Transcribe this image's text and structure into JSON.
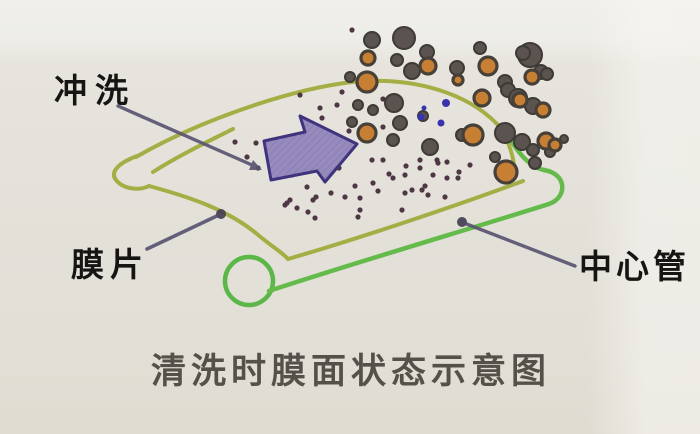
{
  "figure": {
    "labels": {
      "flush": "冲洗",
      "membrane": "膜片",
      "center_tube": "中心管"
    },
    "caption": "清洗时膜面状态示意图"
  },
  "colors": {
    "paper": "#e3e1d9",
    "membrane_line": "#a5ae44",
    "tube_line": "#64bb4b",
    "tube_circle": "#5ab748",
    "arrow_fill": "#978abc",
    "arrow_hatch": "#5e5090",
    "arrow_border": "#40337d",
    "pointer_line": "#5b5472",
    "pointer_dot": "#453f54",
    "dot": "#4e3744",
    "blue_dot": "#3934ae",
    "blob_dark": "#5a534f",
    "blob_edge": "#3e3a36",
    "blob_orange": "#c67f33",
    "blob_ring": "#474039",
    "label_color": "#171513",
    "caption_color": "#54514b"
  },
  "particles": {
    "dark_blobs": [
      [
        372,
        40,
        8
      ],
      [
        404,
        38,
        11
      ],
      [
        427,
        52,
        7
      ],
      [
        397,
        60,
        6
      ],
      [
        412,
        71,
        8
      ],
      [
        457,
        68,
        7
      ],
      [
        480,
        48,
        6
      ],
      [
        530,
        55,
        12
      ],
      [
        541,
        72,
        7
      ],
      [
        350,
        77,
        5
      ],
      [
        505,
        82,
        7
      ],
      [
        547,
        74,
        6
      ],
      [
        394,
        103,
        9
      ],
      [
        358,
        105,
        5
      ],
      [
        373,
        110,
        5
      ],
      [
        508,
        90,
        7
      ],
      [
        518,
        98,
        9
      ],
      [
        533,
        106,
        8
      ],
      [
        352,
        122,
        5
      ],
      [
        400,
        123,
        7
      ],
      [
        423,
        116,
        5
      ],
      [
        462,
        135,
        6
      ],
      [
        505,
        133,
        10
      ],
      [
        522,
        142,
        8
      ],
      [
        393,
        140,
        6
      ],
      [
        430,
        147,
        8
      ],
      [
        535,
        163,
        6
      ],
      [
        550,
        152,
        5
      ],
      [
        495,
        157,
        5
      ],
      [
        523,
        53,
        7
      ],
      [
        533,
        150,
        6
      ],
      [
        564,
        139,
        4
      ]
    ],
    "orange_blobs": [
      [
        368,
        58,
        7
      ],
      [
        428,
        66,
        8
      ],
      [
        488,
        66,
        9
      ],
      [
        367,
        82,
        10
      ],
      [
        532,
        77,
        7
      ],
      [
        482,
        98,
        8
      ],
      [
        543,
        110,
        7
      ],
      [
        473,
        135,
        10
      ],
      [
        546,
        141,
        8
      ],
      [
        367,
        133,
        9
      ],
      [
        506,
        172,
        11
      ],
      [
        555,
        145,
        6
      ],
      [
        458,
        80,
        5
      ],
      [
        520,
        100,
        7
      ]
    ],
    "small_dots": [
      [
        235,
        142
      ],
      [
        256,
        143
      ],
      [
        247,
        157
      ],
      [
        258,
        168
      ],
      [
        300,
        95
      ],
      [
        342,
        92
      ],
      [
        320,
        108
      ],
      [
        302,
        135
      ],
      [
        322,
        140
      ],
      [
        340,
        147
      ],
      [
        292,
        175
      ],
      [
        307,
        187
      ],
      [
        287,
        203
      ],
      [
        337,
        105
      ],
      [
        322,
        118
      ],
      [
        383,
        99
      ],
      [
        349,
        131
      ],
      [
        366,
        128
      ],
      [
        383,
        127
      ],
      [
        350,
        143
      ],
      [
        344,
        155
      ],
      [
        339,
        168
      ],
      [
        372,
        160
      ],
      [
        389,
        174
      ],
      [
        406,
        166
      ],
      [
        420,
        168
      ],
      [
        438,
        163
      ],
      [
        412,
        190
      ],
      [
        425,
        186
      ],
      [
        378,
        191
      ],
      [
        355,
        186
      ],
      [
        316,
        197
      ],
      [
        331,
        193
      ],
      [
        345,
        197
      ],
      [
        360,
        198
      ],
      [
        447,
        178
      ],
      [
        459,
        172
      ],
      [
        313,
        200
      ],
      [
        285,
        205
      ],
      [
        297,
        208
      ],
      [
        358,
        217
      ],
      [
        373,
        183
      ],
      [
        393,
        178
      ],
      [
        405,
        175
      ],
      [
        433,
        175
      ],
      [
        445,
        197
      ],
      [
        405,
        193
      ],
      [
        422,
        190
      ],
      [
        470,
        165
      ],
      [
        458,
        178
      ],
      [
        290,
        200
      ],
      [
        308,
        212
      ],
      [
        315,
        218
      ],
      [
        360,
        210
      ],
      [
        402,
        210
      ],
      [
        428,
        195
      ],
      [
        383,
        160
      ],
      [
        420,
        160
      ],
      [
        437,
        160
      ],
      [
        447,
        162
      ],
      [
        352,
        30
      ]
    ],
    "blue_dots": [
      [
        446,
        103,
        4
      ],
      [
        421,
        117,
        3.5
      ],
      [
        441,
        123,
        3.5
      ],
      [
        424,
        108,
        2.5
      ]
    ]
  }
}
